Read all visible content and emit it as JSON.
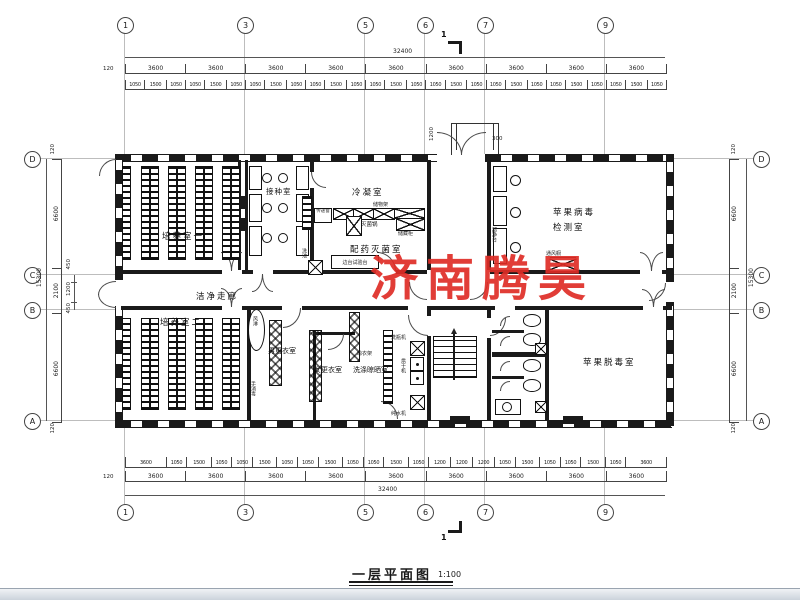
{
  "meta": {
    "watermark": "济南腾昊",
    "title": "一层平面图",
    "scale": "1:100",
    "section_mark": "1"
  },
  "colors": {
    "line": "#1a1a1a",
    "dim": "#444444",
    "watermark": "#de2d26"
  },
  "axes": {
    "top": [
      "1",
      "3",
      "5",
      "6",
      "7",
      "9"
    ],
    "bottom": [
      "1",
      "3",
      "5",
      "6",
      "7",
      "9"
    ],
    "left": [
      "D",
      "C",
      "B",
      "A"
    ],
    "right": [
      "D",
      "C",
      "B",
      "A"
    ]
  },
  "dimensions": {
    "total_width": "32400",
    "total_height": "15300",
    "edge": "120",
    "top_segments": [
      "3600",
      "3600",
      "3600",
      "3600",
      "3600",
      "3600",
      "3600",
      "3600",
      "3600"
    ],
    "top_subdims": [
      "1050",
      "1500",
      "1050",
      "1050",
      "1500",
      "1050",
      "1050",
      "1500",
      "1050",
      "1050",
      "1500",
      "1050",
      "1050",
      "1500",
      "1050",
      "1050",
      "1500",
      "1050",
      "1050",
      "1500",
      "1050",
      "1050",
      "1500",
      "1050",
      "1050",
      "1500",
      "1050"
    ],
    "bottom_segments": [
      "3600",
      "3600",
      "3600",
      "3600",
      "3600",
      "3600",
      "3600",
      "3600",
      "3600"
    ],
    "bottom_subdims": [
      "3600",
      "1050",
      "1500",
      "1050",
      "1050",
      "1500",
      "1050",
      "1050",
      "1500",
      "1050",
      "1050",
      "1500",
      "1050",
      "1200",
      "1200",
      "1200",
      "1050",
      "1500",
      "1050",
      "1050",
      "1500",
      "1050",
      "3600"
    ],
    "side_inner": [
      "6600",
      "2100",
      "6600"
    ],
    "side_sub": [
      "450",
      "1200",
      "450"
    ],
    "entrance_width": "1200",
    "entrance_depth": "300"
  },
  "rooms": {
    "r1": "培养室一",
    "inoculation": "接种室",
    "condensing": "冷凝室",
    "dispensing": "配药灭菌室",
    "virus_test_l1": "苹果病毒",
    "virus_test_l2": "检测室",
    "corridor": "洁净走廊",
    "r2": "培养室二",
    "men_change": "男更衣室",
    "women_change": "女更衣室",
    "washing": "洗涤晾晒室",
    "detox": "苹果脱毒室"
  },
  "equipment": {
    "pass_window": "传递窗",
    "shelf": "储物架",
    "sterilizer": "灭菌锅",
    "storage_cabinet": "储藏柜",
    "bench": "边台试验台",
    "sink": "洗池",
    "clean_bench": "超净台",
    "fume_hood": "通风橱",
    "air_shower": "风淋",
    "hand_sanitize": "手消毒",
    "drying_rack": "晾衣架",
    "bottle_washer": "洗瓶机",
    "dryer": "烘干机",
    "water_purifier": "纯水机"
  }
}
